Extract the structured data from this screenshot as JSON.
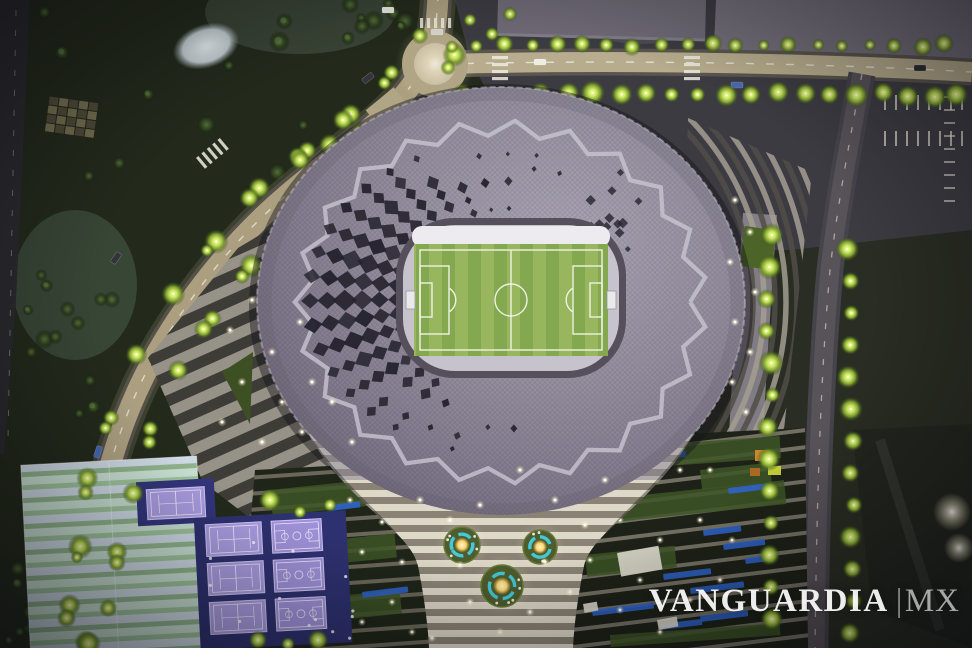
{
  "image": {
    "description": "Aerial night photograph of an illuminated architectural scale model of a Qatar World Cup stadium (diamond-patterned oval roof with central football pitch), surrounded by lit roads, a roundabout, parks, terraced gardens, tennis and basketball courts and office buildings",
    "kind": "photograph"
  },
  "watermark": {
    "text": "VANGUARDIA",
    "separator": "|",
    "suffix": "MX"
  },
  "palette": {
    "park": "#222a1b",
    "park2": "#1b2216",
    "roadLit": "#ab9f80",
    "roadEdge": "#56524a",
    "roadDark": "#46444b",
    "roadDash": "#f2efe3",
    "roundabout": "#cabfa5",
    "roof": "#8d8795",
    "roofLight": "#a8a2b1",
    "roofDark": "#6f687b",
    "zigzag": "#c9c4d1",
    "diamond": "#25232e",
    "rim": "#55505b",
    "bowl": "#c7c3cc",
    "stand": "#edeaf0",
    "pitchA": "#84a850",
    "pitchB": "#97b65e",
    "pitchLine": "#eef2e4",
    "plazaLightStripe": "#b3ada2",
    "plazaDarkStripe": "#46443f",
    "trumpetA": "#ded8c8",
    "trumpetB": "#8a8375",
    "fountainDisc": "#4e5d2d",
    "fountainRing": "#45c8d8",
    "fountainCore": "#ffdf7e",
    "courtViolet": "#a89bdf",
    "courtLine": "#eae6fb",
    "courtApron": "#373a7e",
    "fieldA": "#c8dfd2",
    "fieldB": "#9dc29b",
    "fieldC": "#cdd9e4",
    "terrace": "#20261a",
    "terraceStep": "#8f897c",
    "terraceBlue": "#2f63c8",
    "planter": "#ddd9ce",
    "building": "#716c78",
    "buildingEdge": "#8d8894",
    "treeLitCore": "#f4ff9e",
    "treeLitMid": "#cfe86a",
    "treeLitOut": "#7fa030",
    "treeDarkCore": "#55703a",
    "treeDarkOut": "#2c3d1d",
    "lamp": "#fffdf2"
  },
  "scene": {
    "stadium": {
      "cx": 501,
      "cy": 302,
      "rx": 244,
      "ry": 215
    },
    "pitch": {
      "cx": 511,
      "cy": 298
    },
    "fountains": [
      {
        "cx": 462,
        "cy": 545,
        "r": 18
      },
      {
        "cx": 540,
        "cy": 547,
        "r": 17
      },
      {
        "cx": 502,
        "cy": 586,
        "r": 21
      }
    ],
    "courts": {
      "single_tennis": {
        "x": 150,
        "y": 487,
        "w": 58,
        "h": 30
      },
      "grid": {
        "x": 207,
        "y": 525,
        "cols": [
          "tennis",
          "basketball"
        ],
        "rows": 3,
        "w": 56,
        "h": 32,
        "gapx": 10,
        "gapy": 7
      }
    },
    "counts": {
      "park_trees": 64,
      "roof_diamond_rings": 6,
      "zigzag_points": 46
    }
  }
}
